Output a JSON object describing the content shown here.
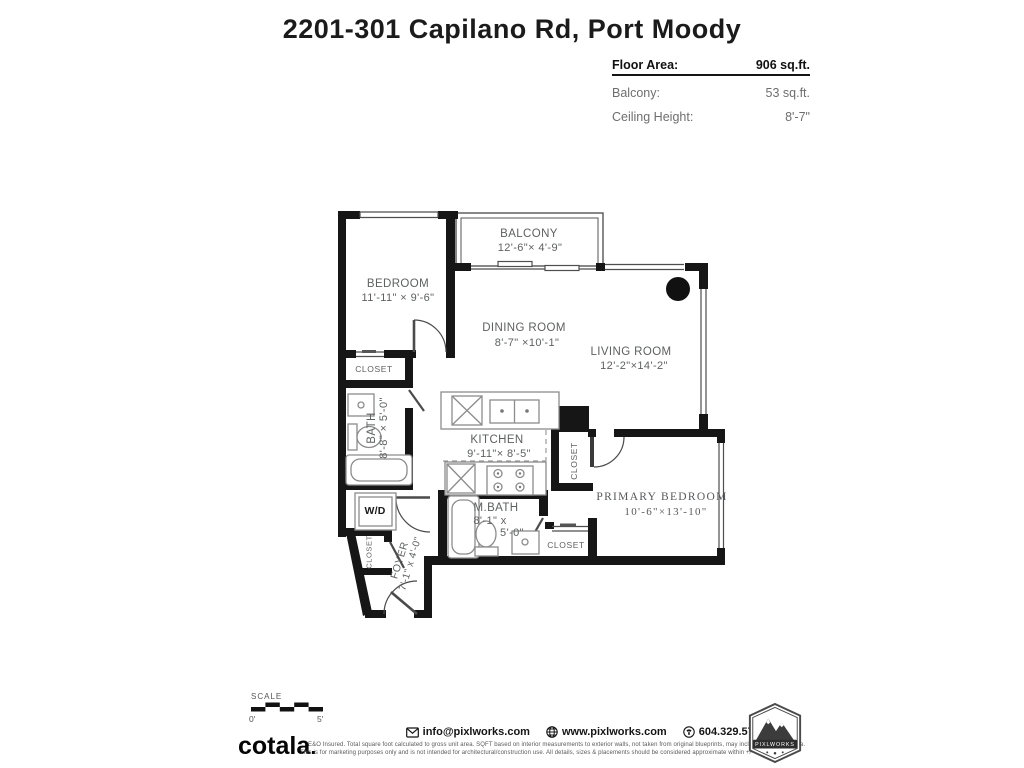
{
  "title": "2201-301 Capilano Rd, Port Moody",
  "info": {
    "floor_area_label": "Floor Area:",
    "floor_area_value": "906 sq.ft.",
    "balcony_label": "Balcony:",
    "balcony_value": "53 sq.ft.",
    "ceiling_label": "Ceiling Height:",
    "ceiling_value": "8'-7\""
  },
  "rooms": {
    "balcony": {
      "name": "BALCONY",
      "dims": "12'-6\"× 4'-9\""
    },
    "bedroom": {
      "name": "BEDROOM",
      "dims": "11'-11\" × 9'-6\""
    },
    "dining": {
      "name": "DINING ROOM",
      "dims": "8'-7\" ×10'-1\""
    },
    "living": {
      "name": "LIVING ROOM",
      "dims": "12'-2\"×14'-2\""
    },
    "kitchen": {
      "name": "KITCHEN",
      "dims": "9'-11\"× 8'-5\""
    },
    "bath": {
      "name": "BATH",
      "dims": "8'-8\" × 5'-0\""
    },
    "mbath": {
      "name": "M.BATH",
      "dims1": "8'-1\" x",
      "dims2": "5'-0\""
    },
    "primary": {
      "name": "PRIMARY BEDROOM",
      "dims": "10'-6\"×13'-10\""
    },
    "foyer": {
      "name": "FOYER",
      "dims": "7'-1\" x 4'-0\""
    },
    "wd": {
      "name": "W/D"
    },
    "closet_bedroom": {
      "name": "CLOSET"
    },
    "closet_hall": {
      "name": "CLOSET"
    },
    "closet_primary": {
      "name": "CLOSET"
    },
    "closet_foyer": {
      "name": "CLOSET"
    }
  },
  "scale": {
    "label": "SCALE",
    "start": "0'",
    "end": "5'"
  },
  "footer": {
    "brand": "cotala",
    "email": "info@pixlworks.com",
    "website": "www.pixlworks.com",
    "phone": "604.329.5788",
    "badge": "PIXLWORKS",
    "disclaimer1": "E&O Insured.  Total square foot calculated to gross unit area. SQFT based on interior measurements to exterior walls, not taken from original blueprints, may include unfinished area.",
    "disclaimer2": "This is for marketing purposes only and is not intended for architectural/construction use.  All details, sizes & placements should be considered approximate within +/- 2% tolerance."
  }
}
